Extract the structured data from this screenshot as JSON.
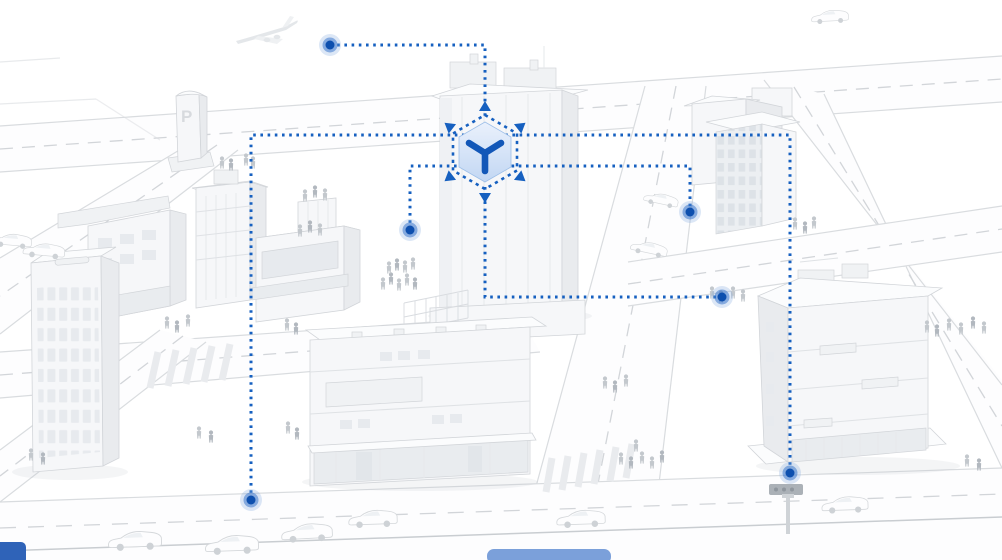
{
  "meta": {
    "width": 1002,
    "height": 560,
    "description": "Isometric white 3D city illustration with a blue dotted connection network linking city hotspots (airspace, streets, plaza, intersections) to a central 3D-cube hub icon"
  },
  "palette": {
    "accent": "#1660c0",
    "cube_axis": "#1257b8",
    "cube_fill_top": "#eaf1fc",
    "cube_fill_bottom": "#c2d7f3",
    "dot_core": "#0d4fae",
    "dot_ring": "rgba(45,110,200,0.50)",
    "dot_halo": "rgba(130,168,224,0.28)",
    "b_front": "#f6f7f9",
    "b_side": "#e9ebee",
    "b_roof": "#fbfcfd",
    "outline": "#d2d5d9",
    "window": "#e7eaee",
    "road_edge": "#d9dcdf",
    "road_dash": "#d2d5d9",
    "people": "#c3c8cd",
    "car_fill": "#fdfdfe",
    "blue_vehicle_dark": "#2f63b8",
    "blue_vehicle_light": "#7ba0da"
  },
  "parking_sign": {
    "label": "P"
  },
  "hub": {
    "icon": "3d-cube-axes-icon",
    "cx": 485,
    "cy": 152
  },
  "connectors": [
    {
      "name": "link-airspace",
      "points": [
        [
          330,
          45
        ],
        [
          485,
          45
        ],
        [
          485,
          117
        ]
      ],
      "dots": [
        [
          330,
          45
        ]
      ]
    },
    {
      "name": "link-outer-loop",
      "points": [
        [
          251,
          500
        ],
        [
          251,
          135
        ],
        [
          790,
          135
        ],
        [
          790,
          473
        ]
      ],
      "dots": [
        [
          251,
          500
        ],
        [
          790,
          473
        ]
      ]
    },
    {
      "name": "link-street-level",
      "points": [
        [
          410,
          230
        ],
        [
          410,
          166
        ],
        [
          690,
          166
        ],
        [
          690,
          212
        ]
      ],
      "dots": [
        [
          410,
          230
        ],
        [
          690,
          212
        ]
      ]
    },
    {
      "name": "link-plaza",
      "points": [
        [
          485,
          187
        ],
        [
          485,
          297
        ],
        [
          722,
          297
        ]
      ],
      "dots": [
        [
          722,
          297
        ]
      ]
    }
  ],
  "scene_objects": [
    "airplane",
    "parking-sign",
    "left-office-tower",
    "retail-block",
    "central-skyscraper",
    "street-retail-building",
    "uptown-block",
    "right-office-building",
    "traffic-signal",
    "cars",
    "pedestrians",
    "road-network",
    "hub-cube-icon",
    "connector-dots"
  ]
}
